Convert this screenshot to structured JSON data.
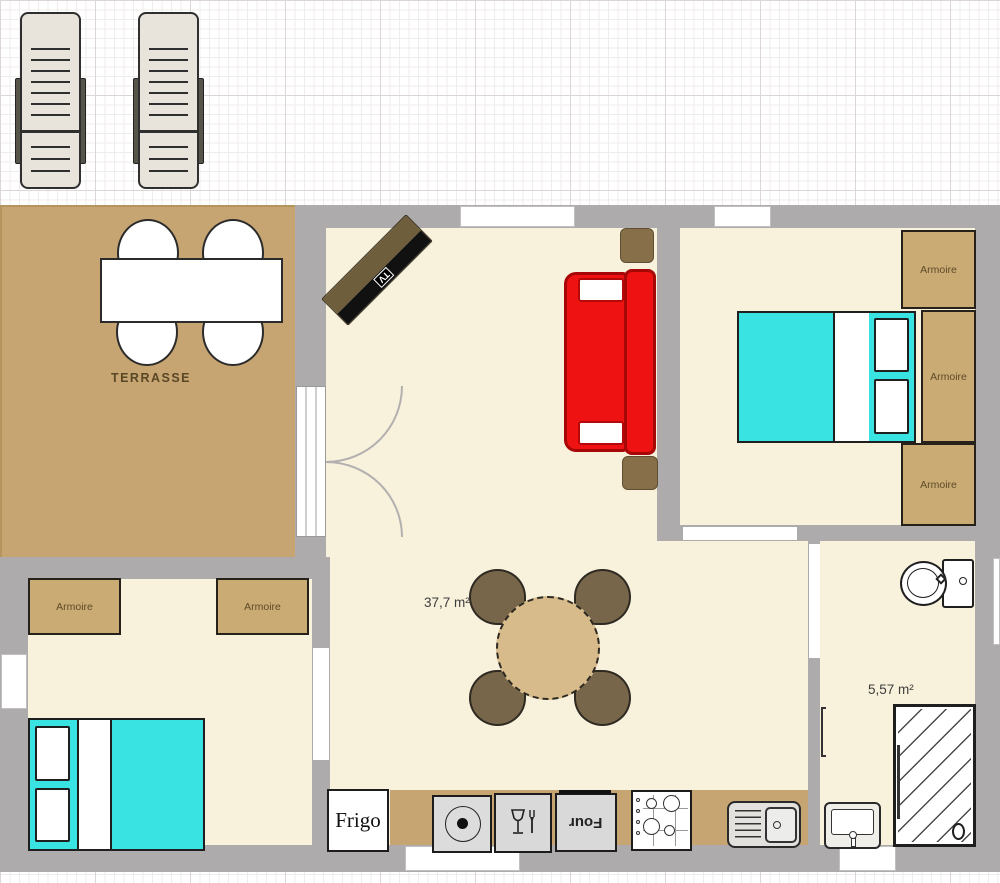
{
  "plan": {
    "type": "floor-plan",
    "labels": {
      "terrace": "TERRASSE",
      "living_area": "37,7 m²",
      "bathroom_area": "5,57 m²",
      "armoire": "Armoire",
      "fridge": "Frigo",
      "oven": "Four",
      "tv": "TV"
    },
    "icons": {
      "hotplate": "circle-dot-icon",
      "dishwasher": "wine-glass-fork-icon",
      "stove": "four-burner-icon",
      "kitchen_sink": "basin-drainboard-icon",
      "toilet": "toilet-icon",
      "shower": "hatched-shower-icon",
      "bathroom_sink": "washbasin-icon"
    },
    "colors": {
      "wall": "#adabab",
      "floor": "#f8f1dc",
      "terrace": "#c7a572",
      "wood": "#cbab74",
      "bed_blanket": "#38e3e1",
      "sofa_red": "#ee1212",
      "table": "#d7bb8b",
      "chair": "#77664a",
      "outline_dark": "#1f1f1f"
    }
  }
}
